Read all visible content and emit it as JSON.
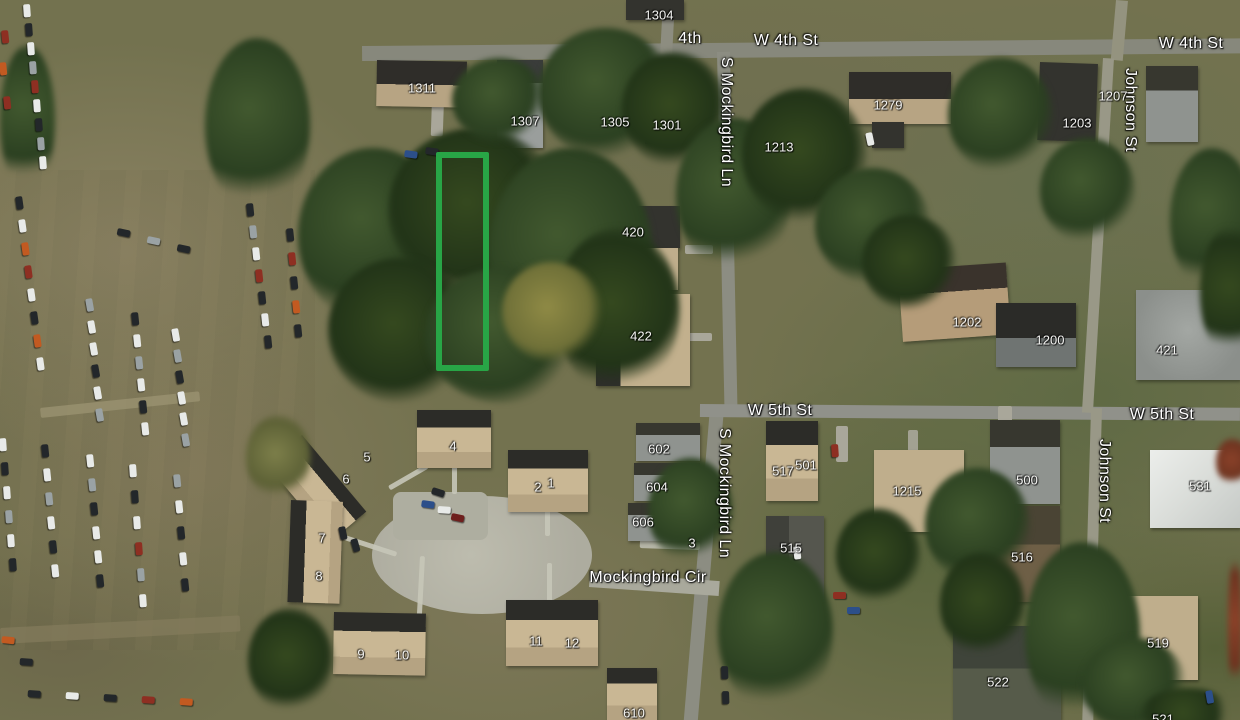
{
  "map": {
    "street_labels": [
      {
        "text": "4th",
        "x": 690,
        "y": 39,
        "rot": 0
      },
      {
        "text": "W 4th St",
        "x": 786,
        "y": 41,
        "rot": 0
      },
      {
        "text": "W 4th St",
        "x": 1191,
        "y": 44,
        "rot": 0
      },
      {
        "text": "S Mockingbird Ln",
        "x": 726,
        "y": 122,
        "rot": 90
      },
      {
        "text": "Johnson St",
        "x": 1130,
        "y": 110,
        "rot": 90
      },
      {
        "text": "W 5th St",
        "x": 780,
        "y": 411,
        "rot": 0
      },
      {
        "text": "W 5th St",
        "x": 1162,
        "y": 415,
        "rot": 0
      },
      {
        "text": "S Mockingbird Ln",
        "x": 724,
        "y": 493,
        "rot": 90
      },
      {
        "text": "Johnson St",
        "x": 1104,
        "y": 481,
        "rot": 90
      },
      {
        "text": "Mockingbird Cir",
        "x": 648,
        "y": 578,
        "rot": 0
      }
    ],
    "address_labels": [
      {
        "text": "1304",
        "x": 659,
        "y": 15
      },
      {
        "text": "1311",
        "x": 422,
        "y": 88
      },
      {
        "text": "1307",
        "x": 525,
        "y": 121
      },
      {
        "text": "1305",
        "x": 615,
        "y": 122
      },
      {
        "text": "1301",
        "x": 667,
        "y": 125
      },
      {
        "text": "1279",
        "x": 888,
        "y": 105
      },
      {
        "text": "1213",
        "x": 779,
        "y": 147
      },
      {
        "text": "1207",
        "x": 1113,
        "y": 96
      },
      {
        "text": "1203",
        "x": 1077,
        "y": 123
      },
      {
        "text": "420",
        "x": 633,
        "y": 232
      },
      {
        "text": "422",
        "x": 641,
        "y": 336
      },
      {
        "text": "1202",
        "x": 967,
        "y": 322
      },
      {
        "text": "1200",
        "x": 1050,
        "y": 340
      },
      {
        "text": "421",
        "x": 1167,
        "y": 350
      },
      {
        "text": "4",
        "x": 453,
        "y": 446
      },
      {
        "text": "5",
        "x": 367,
        "y": 457
      },
      {
        "text": "6",
        "x": 346,
        "y": 479
      },
      {
        "text": "2",
        "x": 538,
        "y": 487
      },
      {
        "text": "1",
        "x": 551,
        "y": 483
      },
      {
        "text": "7",
        "x": 322,
        "y": 538
      },
      {
        "text": "8",
        "x": 319,
        "y": 576
      },
      {
        "text": "9",
        "x": 361,
        "y": 654
      },
      {
        "text": "10",
        "x": 402,
        "y": 655
      },
      {
        "text": "11",
        "x": 536,
        "y": 641
      },
      {
        "text": "12",
        "x": 572,
        "y": 643
      },
      {
        "text": "602",
        "x": 659,
        "y": 449
      },
      {
        "text": "604",
        "x": 657,
        "y": 487
      },
      {
        "text": "606",
        "x": 643,
        "y": 522
      },
      {
        "text": "3",
        "x": 692,
        "y": 543
      },
      {
        "text": "517",
        "x": 783,
        "y": 471
      },
      {
        "text": "501",
        "x": 806,
        "y": 465
      },
      {
        "text": "515",
        "x": 791,
        "y": 548
      },
      {
        "text": "500",
        "x": 1027,
        "y": 480
      },
      {
        "text": "516",
        "x": 1022,
        "y": 557
      },
      {
        "text": "1215",
        "x": 907,
        "y": 491
      },
      {
        "text": "531",
        "x": 1200,
        "y": 486
      },
      {
        "text": "519",
        "x": 1158,
        "y": 643
      },
      {
        "text": "522",
        "x": 998,
        "y": 682
      },
      {
        "text": "610",
        "x": 634,
        "y": 713
      },
      {
        "text": "521",
        "x": 1163,
        "y": 719
      }
    ],
    "parcel_highlight": {
      "color": "#28a546"
    }
  }
}
